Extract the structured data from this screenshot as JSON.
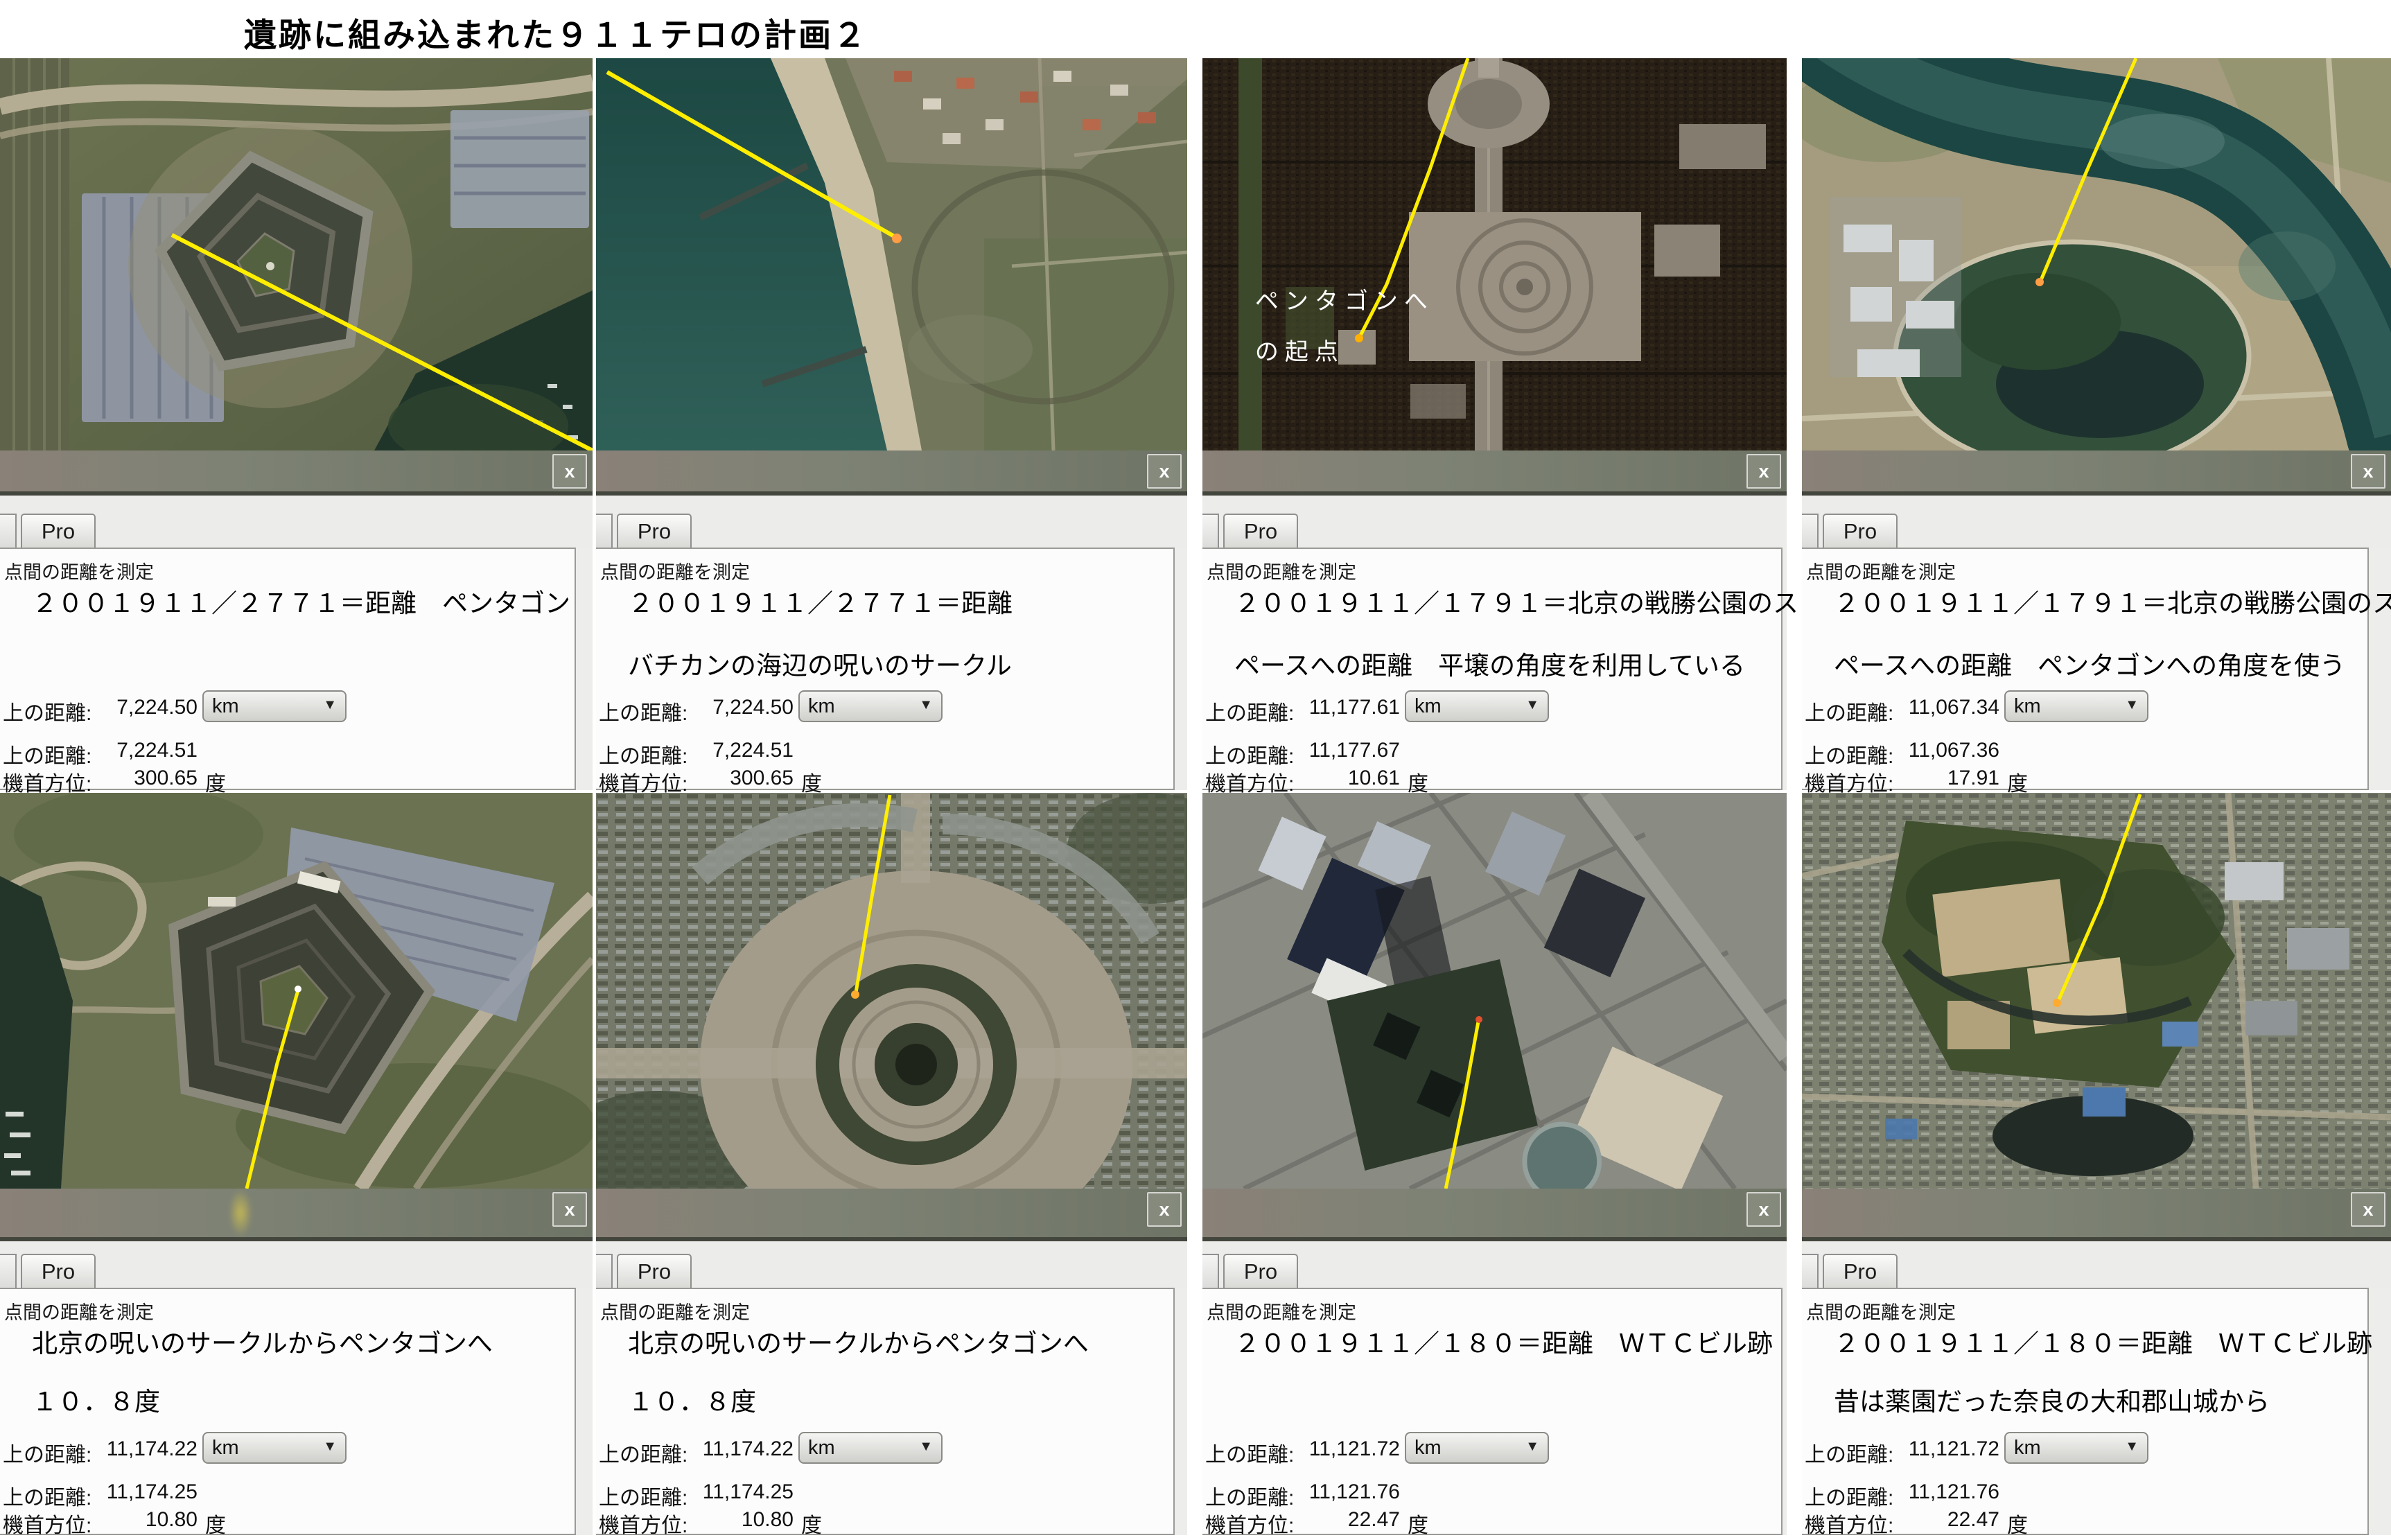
{
  "page_title": "遺跡に組み込まれた９１１テロの計画２",
  "chrome": {
    "tab_label": "Pro",
    "close_glyph": "x"
  },
  "measure": {
    "tool_title": "点間の距離を測定",
    "map_label": "上の距離:",
    "ground_label": "上の距離:",
    "heading_label": "機首方位:",
    "unit": "km",
    "degree_suffix": "度"
  },
  "overlay": {
    "line1": "ペンタゴンへ",
    "line2": "の起点"
  },
  "colors": {
    "measure_line": "#ffee00",
    "marker_orange": "#ff9d45",
    "strip_gray_green": "#7a7f71",
    "panel_border": "#9a9a97",
    "sea_teal": "#2a5a52",
    "water_dark": "#22382b"
  },
  "panels": [
    {
      "desc1": "２００１９１１／２７７１＝距離　ペンタゴン",
      "desc2": "",
      "map": "7,224.50",
      "ground": "7,224.51",
      "heading": "300.65"
    },
    {
      "desc1": "２００１９１１／２７７１＝距離",
      "desc2": "バチカンの海辺の呪いのサークル",
      "map": "7,224.50",
      "ground": "7,224.51",
      "heading": "300.65"
    },
    {
      "desc1": "２００１９１１／１７９１＝北京の戦勝公園のス",
      "desc2": "ペースへの距離　平壌の角度を利用している",
      "map": "11,177.61",
      "ground": "11,177.67",
      "heading": "10.61"
    },
    {
      "desc1": "２００１９１１／１７９１＝北京の戦勝公園のス",
      "desc2": "ペースへの距離　ペンタゴンへの角度を使う",
      "map": "11,067.34",
      "ground": "11,067.36",
      "heading": "17.91"
    },
    {
      "desc1": "北京の呪いのサークルからペンタゴンへ",
      "desc2": "１０．８度",
      "map": "11,174.22",
      "ground": "11,174.25",
      "heading": "10.80"
    },
    {
      "desc1": "北京の呪いのサークルからペンタゴンへ",
      "desc2": "１０．８度",
      "map": "11,174.22",
      "ground": "11,174.25",
      "heading": "10.80"
    },
    {
      "desc1": "２００１９１１／１８０＝距離　ＷＴＣビル跡",
      "desc2": "",
      "map": "11,121.72",
      "ground": "11,121.76",
      "heading": "22.47"
    },
    {
      "desc1": "２００１９１１／１８０＝距離　ＷＴＣビル跡",
      "desc2": "昔は薬園だった奈良の大和郡山城から",
      "map": "11,121.72",
      "ground": "11,121.76",
      "heading": "22.47"
    }
  ]
}
